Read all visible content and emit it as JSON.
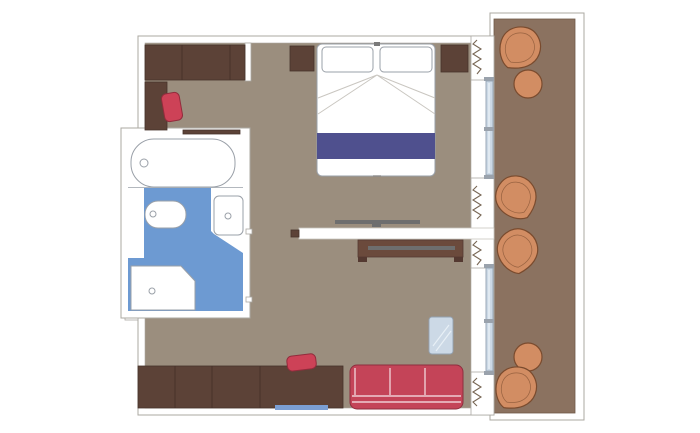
{
  "meta": {
    "label": "Cruise stateroom floor plan with bedroom, bathroom and private balcony",
    "type": "floor-plan",
    "text_visible": ""
  },
  "colors": {
    "floor": "#9B8E7E",
    "balcony_floor": "#8B7260",
    "wood_dark": "#5C4237",
    "wood_mid": "#6B4A3C",
    "wood_edge": "#46322A",
    "bed_runner": "#4F508E",
    "sofa_red": "#C44458",
    "chair_red": "#CD4257",
    "bath_blue": "#6D9AD2",
    "glass": "#CCD9E6",
    "glass_frame": "#93A2B2",
    "balcony_chair": "#D28D63",
    "balcony_chair_edge": "#7A4B2E",
    "wall_line": "#ABA8A2",
    "tv_gray": "#6E6E6E",
    "mat_blue": "#7B9FD4",
    "fixture_line": "#9AA0A8",
    "fold_line": "#C9C6C0"
  },
  "areas": [
    {
      "id": "cabin",
      "glyph": "bedroom-living-area"
    },
    {
      "id": "bathroom",
      "glyph": "bathroom-area"
    },
    {
      "id": "balcony",
      "glyph": "balcony-area"
    }
  ],
  "furniture_glyphs": [
    "wardrobe-icon",
    "desk-icon",
    "desk-chair-icon",
    "shelf-icon",
    "bathtub-icon",
    "toilet-icon",
    "washbasin-icon",
    "shower-tray-icon",
    "double-bed-icon",
    "pillow-icon",
    "bed-runner-icon",
    "nightstand-icon",
    "tv-icon",
    "tv-console-icon",
    "partition-wall-icon",
    "sofa-icon",
    "glass-table-icon",
    "sideboard-icon",
    "stool-icon",
    "floor-mat-icon",
    "curtain-icon",
    "sliding-glass-door-icon",
    "balcony-chair-icon",
    "balcony-table-icon"
  ]
}
